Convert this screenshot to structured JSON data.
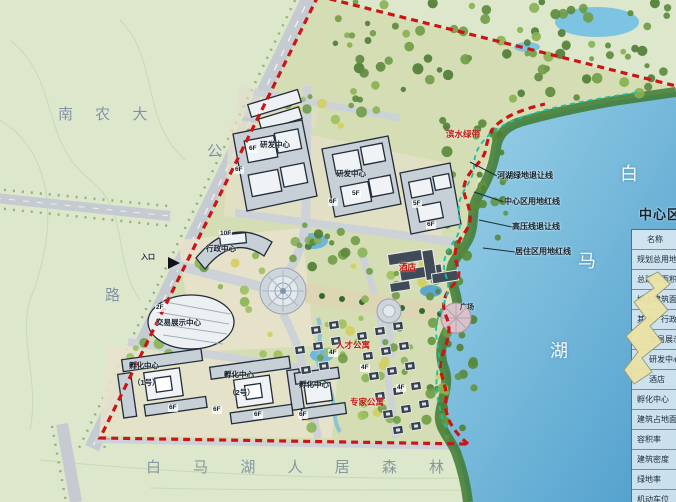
{
  "title": "白马湖中心区规划总平面图",
  "colors": {
    "boundary_red": "#cc1414",
    "setback_teal": "#12c2a8",
    "lake_blue": "#63b1d8",
    "field_green": "#dde7cb",
    "red_label": "#c31616"
  },
  "panel": {
    "title": "中心区经济技术指标",
    "rows": [
      {
        "label": "名称",
        "cls": "first"
      },
      {
        "label": "规划总用地",
        "cls": ""
      },
      {
        "label": "总建筑面积",
        "cls": ""
      },
      {
        "label": "地上建筑面积",
        "cls": ""
      },
      {
        "label": "其中：行政中心",
        "cls": ""
      },
      {
        "label": "交易展示中心",
        "cls": "indent"
      },
      {
        "label": "研发中心",
        "cls": "indent"
      },
      {
        "label": "酒店",
        "cls": "indent"
      },
      {
        "label": "孵化中心",
        "cls": ""
      },
      {
        "label": "建筑占地面积",
        "cls": ""
      },
      {
        "label": "容积率",
        "cls": ""
      },
      {
        "label": "建筑密度",
        "cls": ""
      },
      {
        "label": "绿地率",
        "cls": ""
      },
      {
        "label": "机动车位",
        "cls": ""
      }
    ]
  },
  "map": {
    "labels": [
      {
        "name": "label-nongda",
        "text": "南 农 大",
        "x": 58,
        "y": 103,
        "cls": "geo"
      },
      {
        "name": "label-road-gong",
        "text": "公",
        "x": 207,
        "y": 140,
        "cls": "geo"
      },
      {
        "name": "label-road-lu",
        "text": "路",
        "x": 105,
        "y": 284,
        "cls": "geo"
      },
      {
        "name": "label-forest",
        "text": "白 马 湖 人 居 森 林",
        "x": 146,
        "y": 456,
        "cls": "geo-lg"
      },
      {
        "name": "label-lake-bai",
        "text": "白",
        "x": 620,
        "y": 160,
        "cls": "lake"
      },
      {
        "name": "label-lake-ma",
        "text": "马",
        "x": 578,
        "y": 247,
        "cls": "lake"
      },
      {
        "name": "label-lake-hu",
        "text": "湖",
        "x": 550,
        "y": 337,
        "cls": "lake"
      },
      {
        "name": "label-setback-river",
        "text": "河湖绿地退让线",
        "x": 497,
        "y": 170,
        "cls": "leader"
      },
      {
        "name": "label-redline-center",
        "text": "中心区用地红线",
        "x": 504,
        "y": 196,
        "cls": "leader"
      },
      {
        "name": "label-setback-voltage",
        "text": "高压线退让线",
        "x": 512,
        "y": 221,
        "cls": "leader"
      },
      {
        "name": "label-redline-resi",
        "text": "居住区用地红线",
        "x": 515,
        "y": 246,
        "cls": "leader"
      },
      {
        "name": "label-entrance",
        "text": "入口",
        "x": 141,
        "y": 252,
        "cls": "tiny"
      },
      {
        "name": "label-admin-center",
        "text": "行政中心",
        "x": 206,
        "y": 243,
        "cls": "bldg"
      },
      {
        "name": "label-expo-center",
        "text": "交易展示中心",
        "x": 156,
        "y": 317,
        "cls": "bldg"
      },
      {
        "name": "label-rd-center-1",
        "text": "研发中心",
        "x": 260,
        "y": 139,
        "cls": "bldg"
      },
      {
        "name": "label-rd-center-2",
        "text": "研发中心",
        "x": 336,
        "y": 168,
        "cls": "bldg"
      },
      {
        "name": "label-hotel",
        "text": "酒店",
        "x": 399,
        "y": 261,
        "cls": "red"
      },
      {
        "name": "label-plaza",
        "text": "广场",
        "x": 460,
        "y": 302,
        "cls": "tiny"
      },
      {
        "name": "label-apartment-1",
        "text": "人才公寓",
        "x": 336,
        "y": 339,
        "cls": "red"
      },
      {
        "name": "label-apartment-2",
        "text": "专家公寓",
        "x": 350,
        "y": 396,
        "cls": "red"
      },
      {
        "name": "label-waterfront",
        "text": "滨水绿带",
        "x": 446,
        "y": 128,
        "cls": "red"
      },
      {
        "name": "label-incubator-1",
        "text": "孵化中心",
        "x": 129,
        "y": 360,
        "cls": "bldg"
      },
      {
        "name": "label-incubator-1-no",
        "text": "（1号）",
        "x": 133,
        "y": 377,
        "cls": "bldg"
      },
      {
        "name": "label-incubator-2",
        "text": "孵化中心",
        "x": 224,
        "y": 369,
        "cls": "bldg"
      },
      {
        "name": "label-incubator-2-no",
        "text": "（2号）",
        "x": 228,
        "y": 387,
        "cls": "bldg"
      },
      {
        "name": "label-incubator-3",
        "text": "孵化中心",
        "x": 299,
        "y": 379,
        "cls": "bldg"
      }
    ],
    "floor_tags": [
      {
        "text": "10F",
        "x": 219,
        "y": 230
      },
      {
        "text": "2F",
        "x": 155,
        "y": 304
      },
      {
        "text": "6F",
        "x": 248,
        "y": 145
      },
      {
        "text": "6F",
        "x": 234,
        "y": 166
      },
      {
        "text": "6F",
        "x": 328,
        "y": 198
      },
      {
        "text": "5F",
        "x": 351,
        "y": 190
      },
      {
        "text": "5F",
        "x": 412,
        "y": 200
      },
      {
        "text": "6F",
        "x": 426,
        "y": 221
      },
      {
        "text": "6F",
        "x": 168,
        "y": 404
      },
      {
        "text": "6F",
        "x": 212,
        "y": 406
      },
      {
        "text": "6F",
        "x": 253,
        "y": 411
      },
      {
        "text": "6F",
        "x": 298,
        "y": 411
      },
      {
        "text": "4F",
        "x": 328,
        "y": 349
      },
      {
        "text": "4F",
        "x": 360,
        "y": 364
      },
      {
        "text": "4F",
        "x": 396,
        "y": 384
      }
    ]
  }
}
